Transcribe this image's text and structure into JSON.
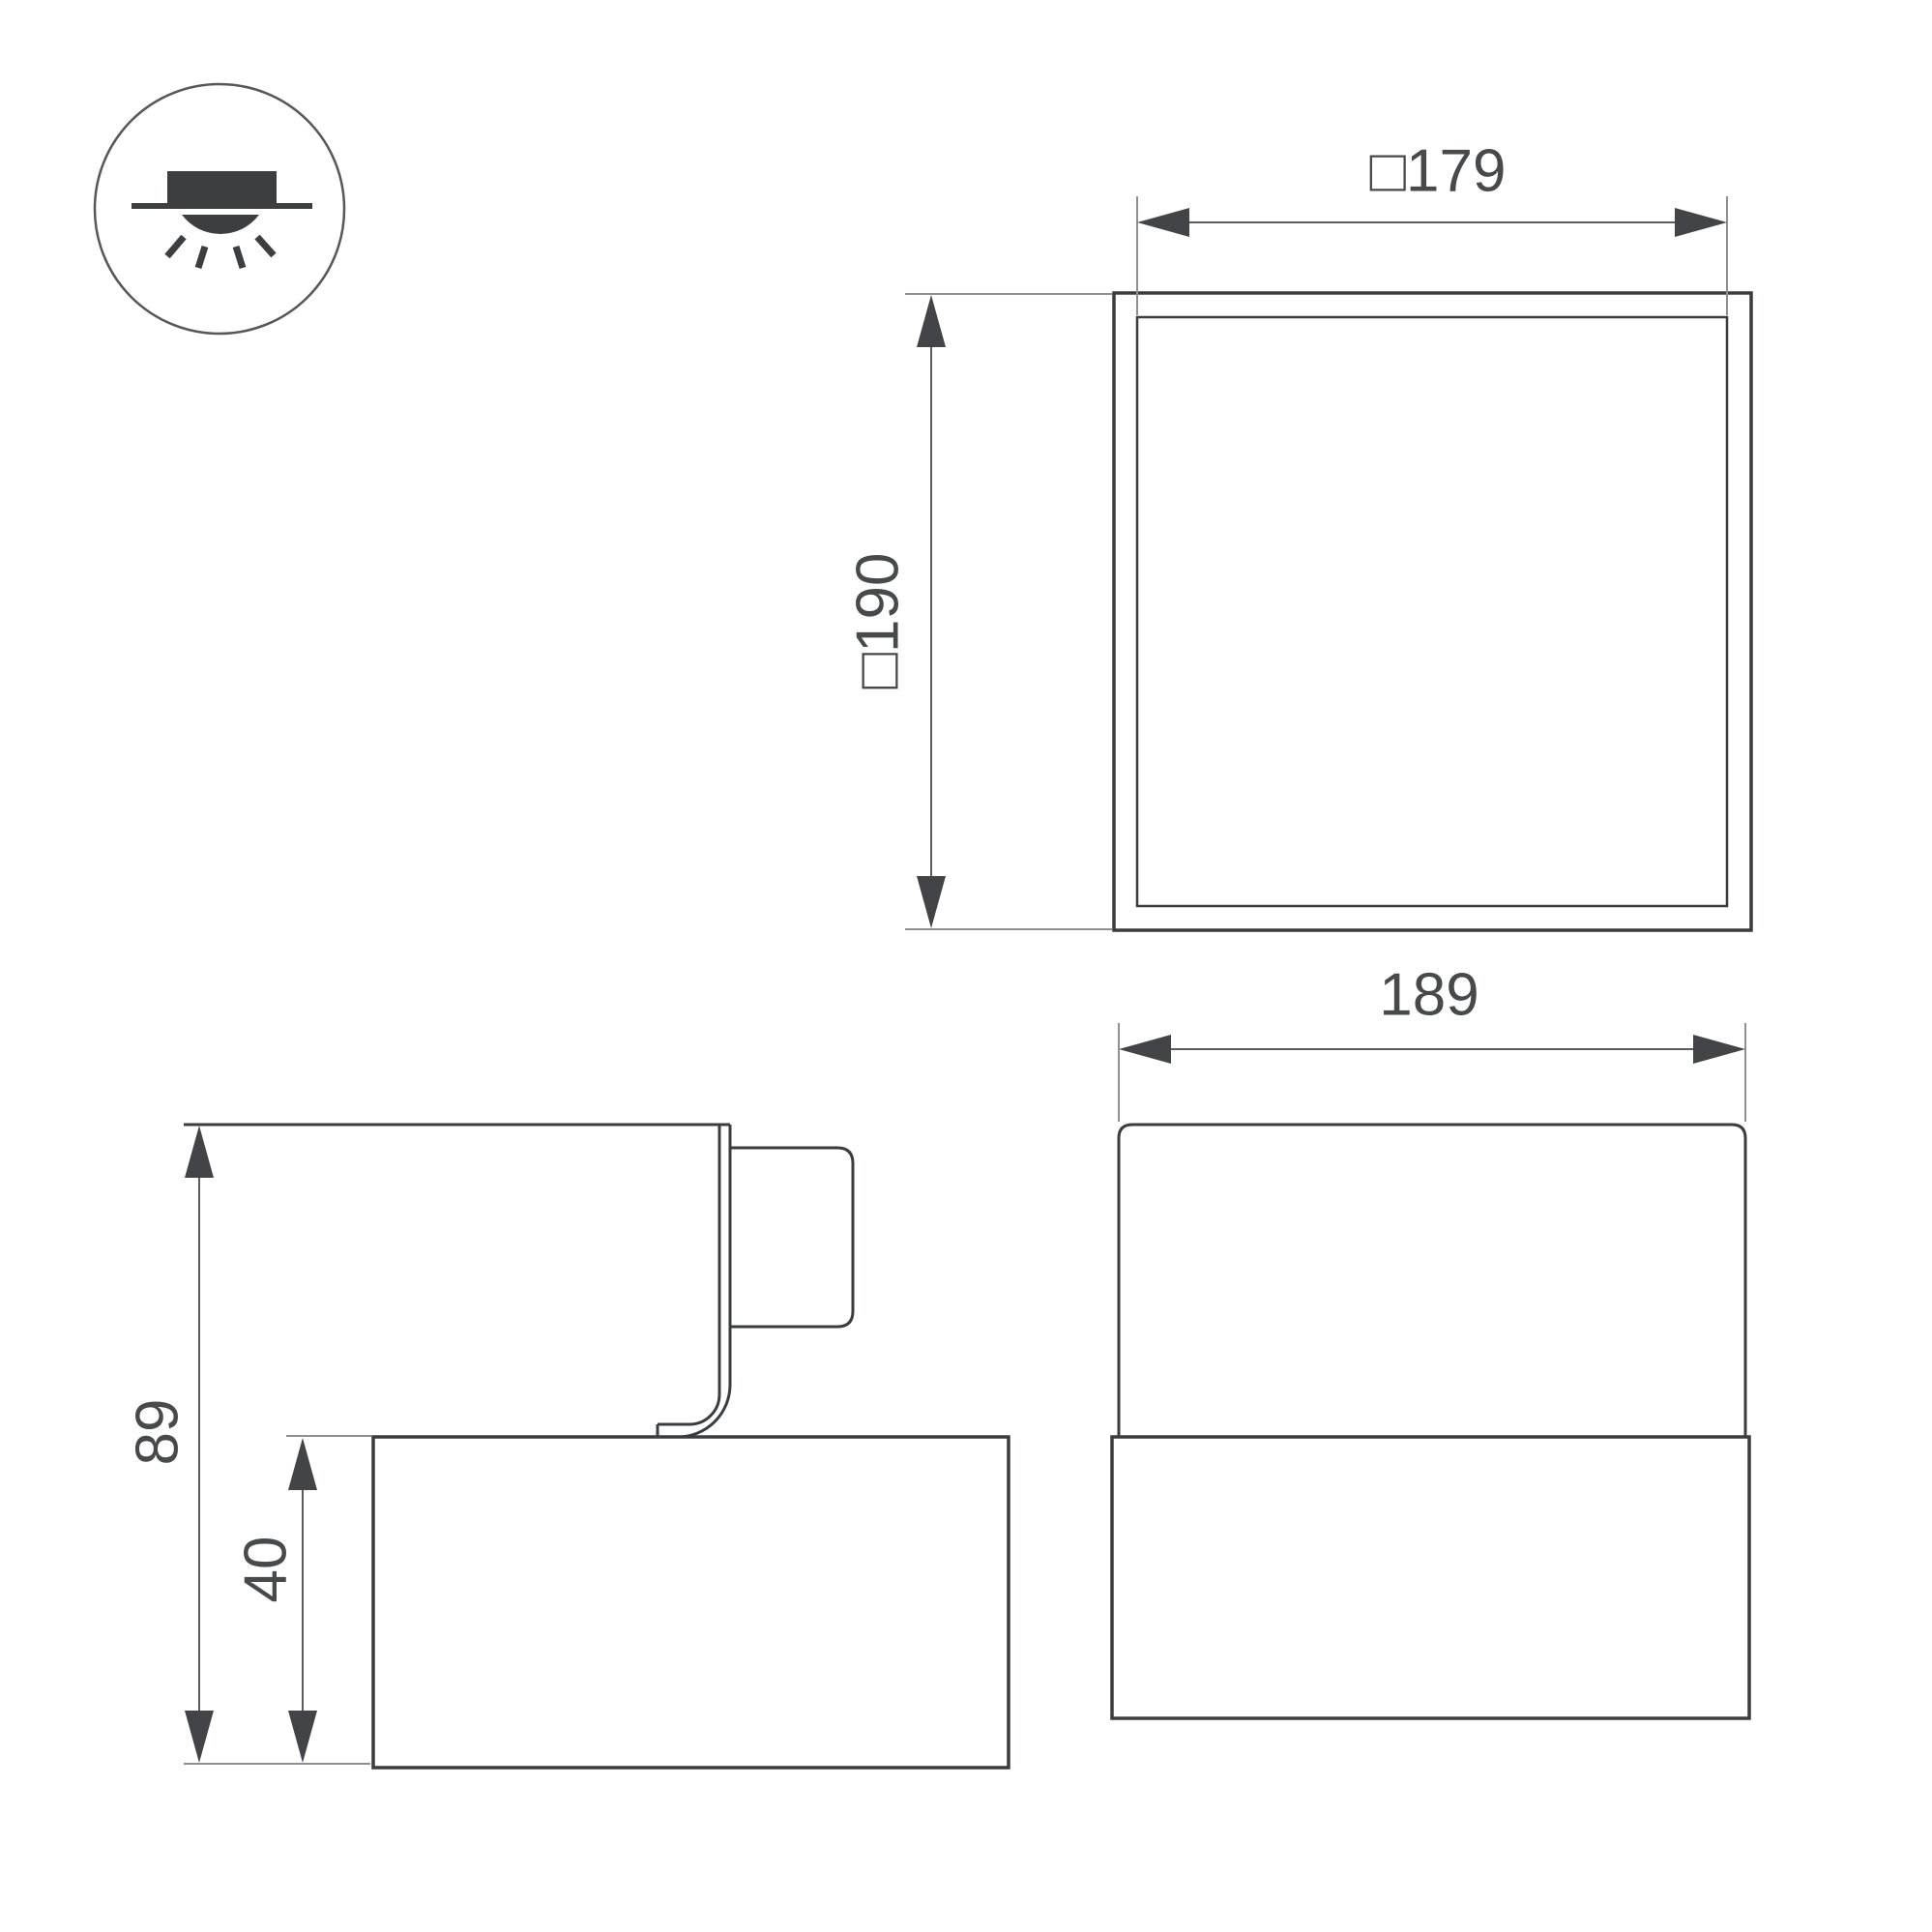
{
  "icon": {
    "name": "surface-mounted-ceiling-light-icon"
  },
  "views": {
    "top": {
      "width_label": "□179",
      "height_label": "□190"
    },
    "front": {
      "width_label": "189"
    },
    "side": {
      "total_height_label": "89",
      "base_height_label": "40"
    }
  },
  "colors": {
    "object_line": "#3b3c3e",
    "dimension_line": "#5a5b5e",
    "extension_line": "#8f9093",
    "arrow_fill": "#434447",
    "text": "#48494b",
    "background": "#ffffff"
  }
}
